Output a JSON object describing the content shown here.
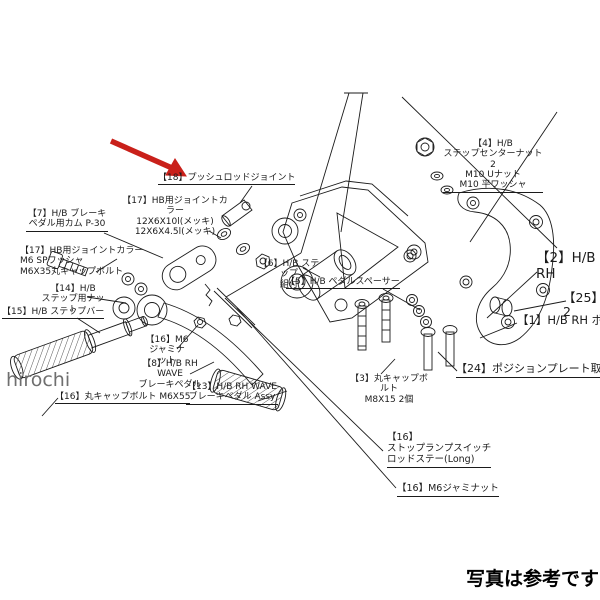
{
  "image": {
    "watermark": "hirochi",
    "caption": "写真は参考です",
    "arrow_color": "#c9201a",
    "line_color": "#1b1b1b",
    "description": "exploded-parts-diagram-rearset"
  },
  "labels": {
    "l18": {
      "text": "【18】プッシュロッドジョイント"
    },
    "l17a": {
      "text": "【17】HB用ジョイントカラー\n12X6X10l(メッキ)\n12X6X4.5l(メッキ)"
    },
    "l7": {
      "text": "【7】H/B ブレーキ\nペダル用カム P-30"
    },
    "l17b": {
      "text": "【17】HB用ジョイントカラー\nM6 SPワッシャ\nM6X35丸キャップボルト"
    },
    "l14": {
      "text": "【14】H/B\nステップ用ナット"
    },
    "l15": {
      "text": "【15】H/B ステップバー"
    },
    "l16a": {
      "text": "【16】M6\nジャミナット"
    },
    "l8": {
      "text": "【8】H/B RH WAVE\nブレーキペダル"
    },
    "l16b": {
      "text": "【16】丸キャップボルト M6X55"
    },
    "l13": {
      "text": "【13】H/B RH WAVE\nブレーキペダル Assy"
    },
    "l6": {
      "text": "【6】H/B ステップ\n組付"
    },
    "l5": {
      "text": "【5】H/B ペダルスペーサー"
    },
    "l4": {
      "text": "【4】H/B\nステップセンターナット2\nM10 Uナット\nM10 平ワッシャ"
    },
    "l2": {
      "text": "【2】H/B RH"
    },
    "l25": {
      "text": "【25】2"
    },
    "l1": {
      "text": "【1】H/B RH ポジションプレート"
    },
    "l24": {
      "text": "【24】ポジションプレート取付ボルト"
    },
    "l3": {
      "text": "【3】丸キャップボルト\nM8X15 2個"
    },
    "l16c": {
      "text": "【16】\nストップランプスイッチ\nロッドステー(Long)"
    },
    "l16d": {
      "text": "【16】M6ジャミナット"
    }
  }
}
